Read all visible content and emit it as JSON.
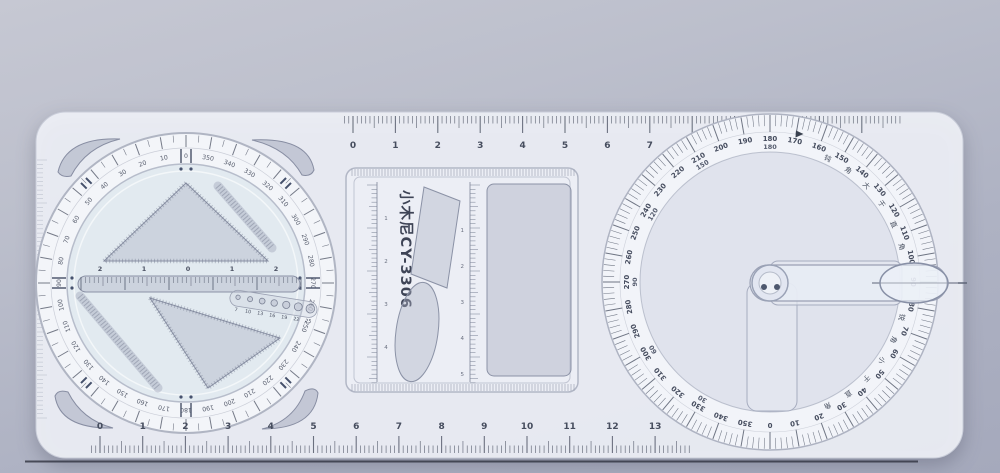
{
  "colors": {
    "background_top": "#c6c8d3",
    "background_bottom": "#a5a9bc",
    "ruler_body": "#edeff5",
    "markings": "#565c6c",
    "cutout_hole": "#aab0c4",
    "desk_edge_line": "#383b47"
  },
  "top_ruler": {
    "unit_labels": [
      0,
      1,
      2,
      3,
      4,
      5,
      6,
      7
    ]
  },
  "bottom_ruler": {
    "unit_labels": [
      0,
      1,
      2,
      3,
      4,
      5,
      6,
      7,
      8,
      9,
      10,
      11,
      12,
      13
    ]
  },
  "left_dial": {
    "degree_labels": [
      0,
      10,
      20,
      30,
      40,
      50,
      60,
      70,
      80,
      90,
      100,
      110,
      120,
      130,
      140,
      150,
      160,
      170,
      180,
      190,
      200,
      210,
      220,
      230,
      240,
      250,
      260,
      270,
      280,
      290,
      300,
      310,
      320,
      330,
      340,
      350
    ],
    "center_ruler_labels": [
      "2",
      "1",
      "0",
      "1",
      "2"
    ],
    "circle_template_labels": [
      "7",
      "10",
      "13",
      "16",
      "19",
      "22",
      "25"
    ]
  },
  "template_panel": {
    "brand": "小木尼CY-3306",
    "left_ruler_labels": [
      "1",
      "2",
      "3",
      "4"
    ],
    "center_ruler_labels": [
      "1",
      "2",
      "3",
      "4",
      "5"
    ]
  },
  "protractor": {
    "outer_labels": [
      0,
      10,
      20,
      30,
      40,
      50,
      60,
      70,
      80,
      90,
      100,
      110,
      120,
      130,
      140,
      150,
      160,
      170,
      180,
      190,
      200,
      210,
      220,
      230,
      240,
      250,
      260,
      270,
      280,
      290,
      300,
      310,
      320,
      330,
      340,
      350
    ],
    "inner_labels": [
      30,
      60,
      90,
      120,
      150,
      180
    ],
    "phrase_upper": "钝角大于直角",
    "phrase_lower": "锐角小于直角"
  }
}
